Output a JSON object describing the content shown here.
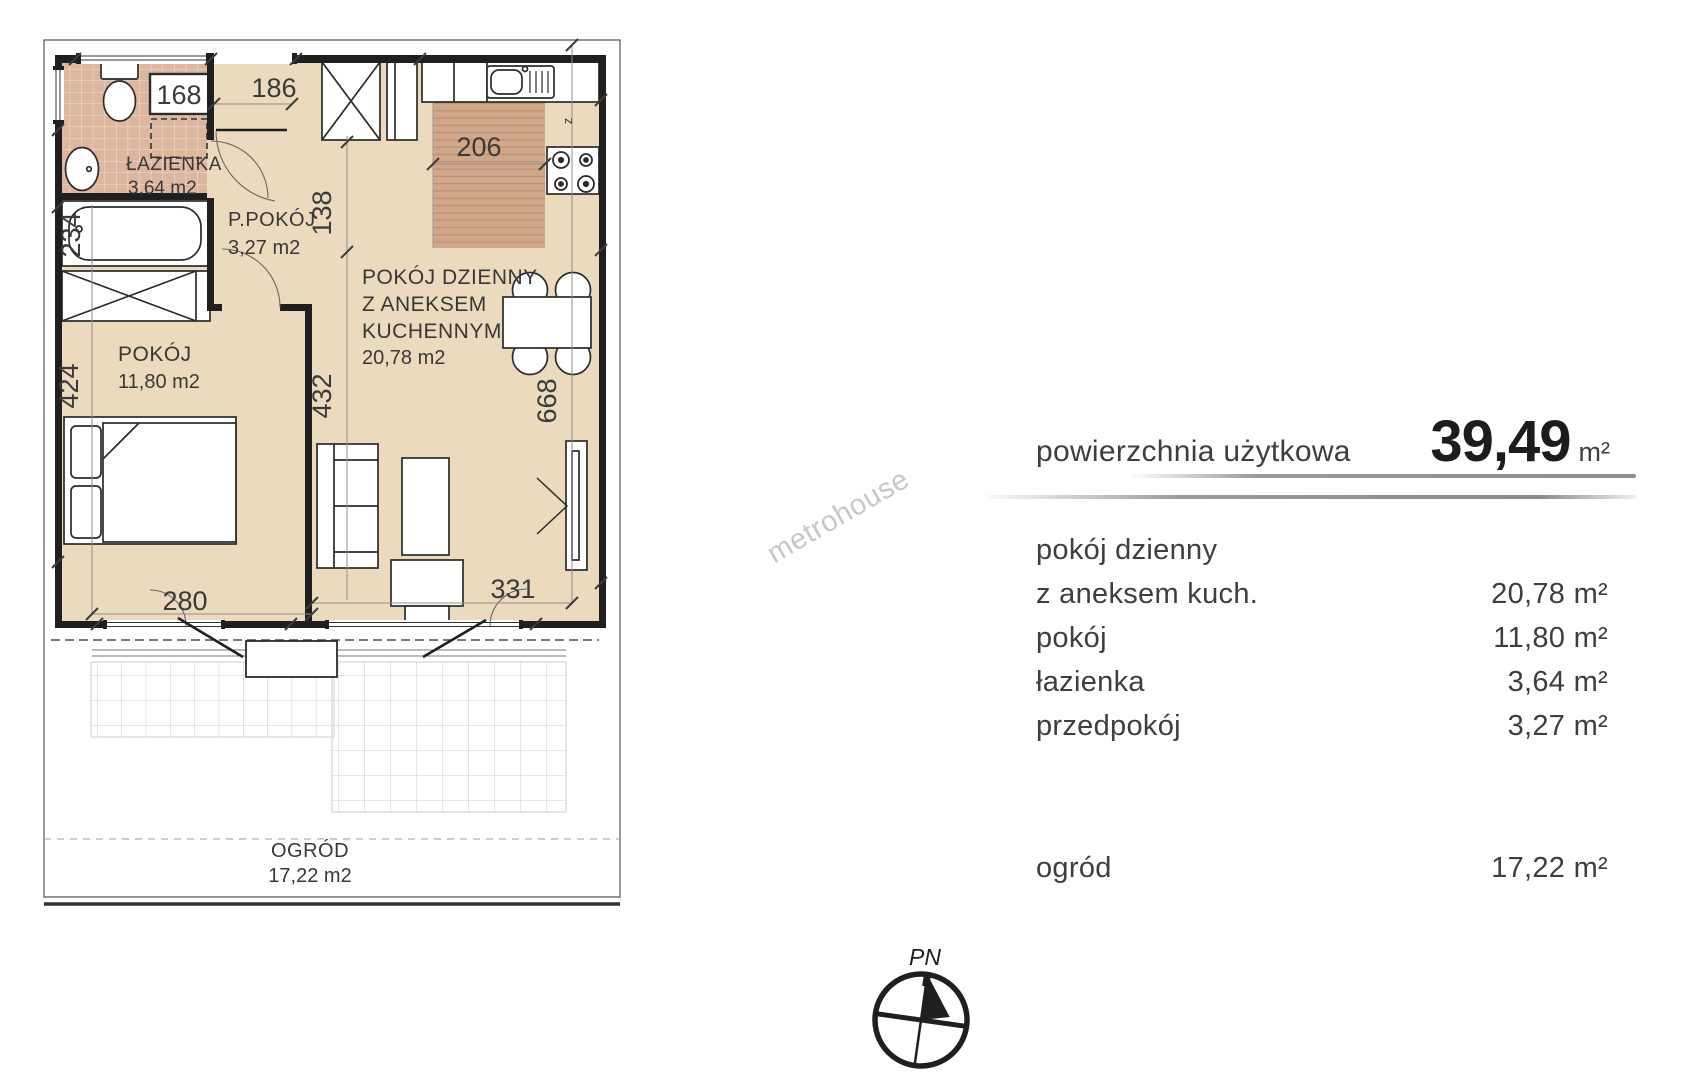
{
  "plan": {
    "rooms": {
      "lazienka": {
        "name": "ŁAZIENKA",
        "area": "3,64 m2"
      },
      "ppokoj": {
        "name": "P.POKÓJ",
        "area": "3,27 m2"
      },
      "pokoj": {
        "name": "POKÓJ",
        "area": "11,80 m2"
      },
      "dzienny": {
        "line1": "POKÓJ DZIENNY",
        "line2": "Z ANEKSEM",
        "line3": "KUCHENNYM",
        "area": "20,78 m2"
      },
      "ogrod": {
        "name": "OGRÓD",
        "area": "17,22 m2"
      }
    },
    "dims": {
      "washer": "168",
      "entry": "186",
      "kitchen": "206",
      "hall": "138",
      "bath": "234",
      "left_wall": "424",
      "mid": "432",
      "right_wall": "668",
      "bottom_left": "280",
      "bottom_right": "331",
      "vent": "z"
    }
  },
  "watermark": "metrohouse",
  "panel": {
    "header": {
      "label": "powierzchnia użytkowa",
      "value": "39,49",
      "unit": "m²"
    },
    "rows": [
      {
        "label": "pokój dzienny",
        "value": ""
      },
      {
        "label": "z aneksem kuch.",
        "value": "20,78 m²"
      },
      {
        "label": "pokój",
        "value": "11,80 m²"
      },
      {
        "label": "łazienka",
        "value": "3,64 m²"
      },
      {
        "label": "przedpokój",
        "value": "3,27 m²"
      },
      {
        "label": "ogród",
        "value": "17,22 m²"
      }
    ]
  },
  "compass": {
    "label": "PN"
  },
  "colors": {
    "floor": "#ebdabd",
    "tile": "#dcb69e",
    "wood": "#d0a78a",
    "line": "#2b2b2b"
  }
}
